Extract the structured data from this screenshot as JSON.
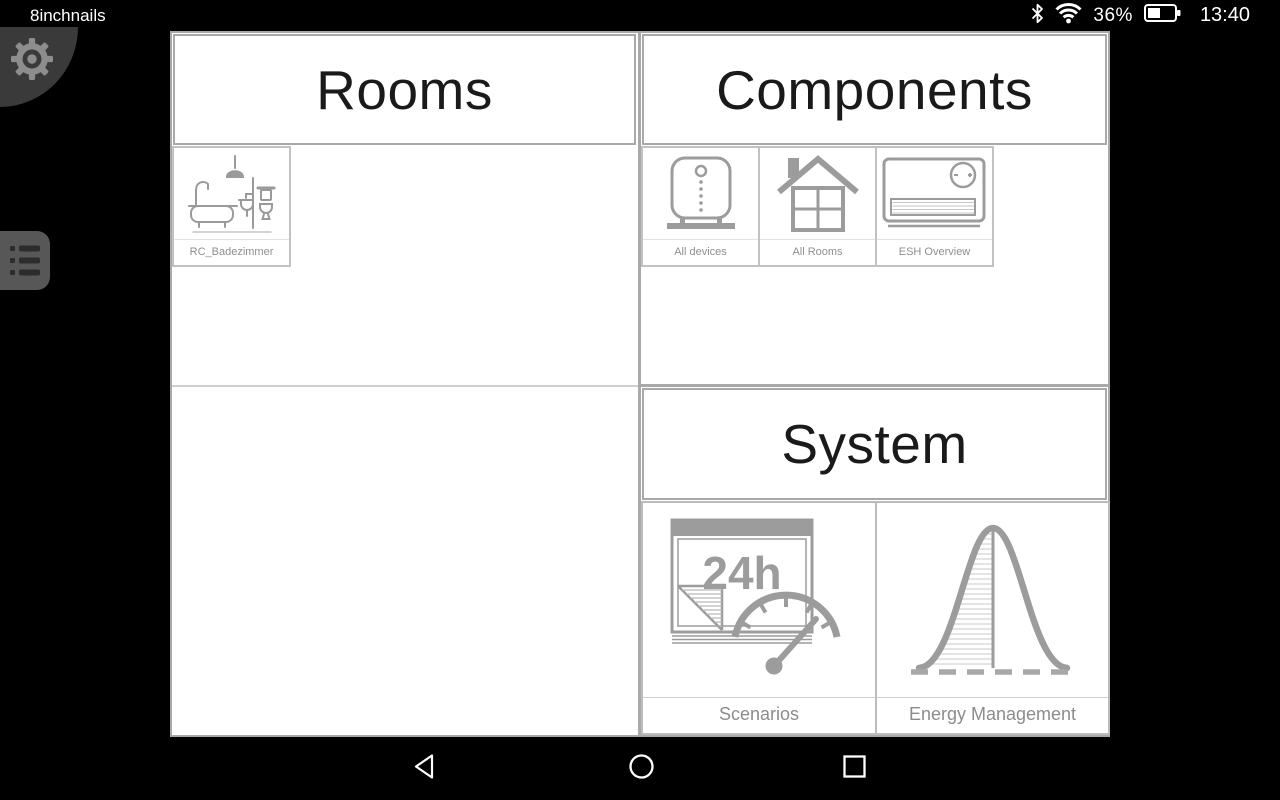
{
  "status_bar": {
    "app_label": "8inchnails",
    "battery_percent": "36%",
    "time": "13:40"
  },
  "content": {
    "rooms": {
      "title": "Rooms",
      "tiles": [
        {
          "label": "RC_Badezimmer",
          "icon": "bathroom-icon"
        }
      ]
    },
    "components": {
      "title": "Components",
      "tiles": [
        {
          "label": "All devices",
          "icon": "device-icon"
        },
        {
          "label": "All Rooms",
          "icon": "house-icon"
        },
        {
          "label": "ESH Overview",
          "icon": "heater-icon"
        }
      ]
    },
    "system": {
      "title": "System",
      "tiles": [
        {
          "label": "Scenarios",
          "icon": "calendar-gauge-icon",
          "icon_text": "24h"
        },
        {
          "label": "Energy Management",
          "icon": "bell-curve-icon"
        }
      ]
    }
  },
  "icons": {
    "status": [
      "bluetooth-icon",
      "wifi-icon",
      "battery-icon"
    ],
    "side": [
      "gear-icon",
      "list-menu-icon"
    ],
    "nav": [
      "back-icon",
      "home-icon",
      "recents-icon"
    ]
  },
  "colors": {
    "background": "#000000",
    "surface": "#ffffff",
    "grid_border": "#a9a9a9",
    "tile_border": "#c2c2c2",
    "icon_gray": "#9c9c9c",
    "label_gray": "#8c8c8c",
    "header_text": "#1a1a1a",
    "status_text": "#ffffff"
  }
}
